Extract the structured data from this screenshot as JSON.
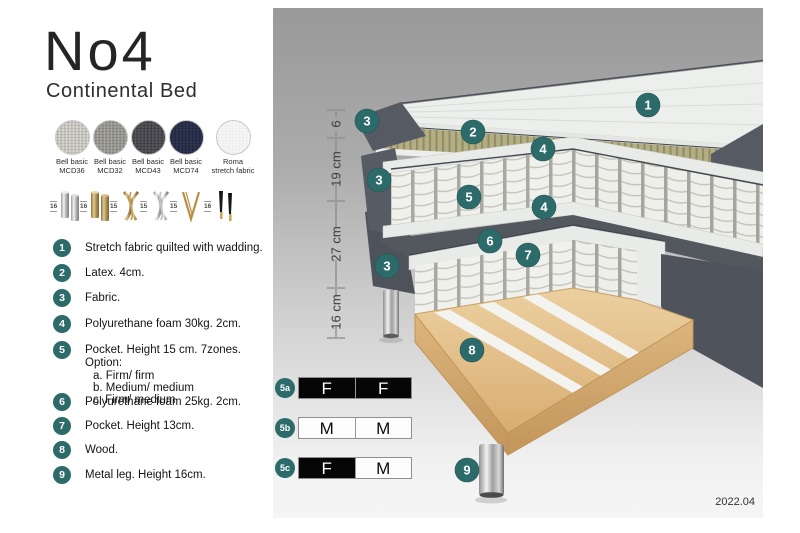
{
  "header": {
    "title": "No4",
    "subtitle": "Continental Bed"
  },
  "fabric_swatches": [
    {
      "line1": "Bell basic",
      "line2": "MCD36",
      "color": "#d6d4ce",
      "dot": "#aeaca4"
    },
    {
      "line1": "Bell basic",
      "line2": "MCD32",
      "color": "#a5a49e",
      "dot": "#807f79"
    },
    {
      "line1": "Bell basic",
      "line2": "MCD43",
      "color": "#55555a",
      "dot": "#393940"
    },
    {
      "line1": "Bell basic",
      "line2": "MCD74",
      "color": "#2f3554",
      "dot": "#1f2439"
    },
    {
      "line1": "Roma",
      "line2": "stretch fabric",
      "color": "#f7f7f7",
      "dot": "#ebebeb"
    }
  ],
  "leg_options": [
    {
      "height": "16",
      "style": "cylinder-silver"
    },
    {
      "height": "16",
      "style": "cylinder-brass"
    },
    {
      "height": "15",
      "style": "twist-gold"
    },
    {
      "height": "15",
      "style": "twist-silver"
    },
    {
      "height": "15",
      "style": "hairpin-gold"
    },
    {
      "height": "16",
      "style": "cone-black-gold"
    }
  ],
  "parts": [
    {
      "num": "1",
      "text": "Stretch fabric quilted with wadding.",
      "sub": []
    },
    {
      "num": "2",
      "text": "Latex. 4cm.",
      "sub": []
    },
    {
      "num": "3",
      "text": "Fabric.",
      "sub": []
    },
    {
      "num": "4",
      "text": "Polyurethane foam 30kg. 2cm.",
      "sub": []
    },
    {
      "num": "5",
      "text": "Pocket. Height 15 cm. 7zones. Option:",
      "sub": [
        "a. Firm/ firm",
        "b. Medium/ medium",
        "c. Firm/ medium"
      ]
    },
    {
      "num": "6",
      "text": "Polyurethane foam 25kg. 2cm.",
      "sub": []
    },
    {
      "num": "7",
      "text": "Pocket. Height 13cm.",
      "sub": []
    },
    {
      "num": "8",
      "text": "Wood.",
      "sub": []
    },
    {
      "num": "9",
      "text": "Metal leg. Height 16cm.",
      "sub": []
    }
  ],
  "diagram": {
    "measurements": [
      {
        "label": "6"
      },
      {
        "label": "19 cm"
      },
      {
        "label": "27 cm"
      },
      {
        "label": "16 cm"
      }
    ],
    "callouts": [
      {
        "label": "1"
      },
      {
        "label": "2"
      },
      {
        "label": "3"
      },
      {
        "label": "4"
      },
      {
        "label": "3"
      },
      {
        "label": "5"
      },
      {
        "label": "4"
      },
      {
        "label": "6"
      },
      {
        "label": "7"
      },
      {
        "label": "3"
      },
      {
        "label": "8"
      },
      {
        "label": "9"
      }
    ],
    "firmness_options": [
      {
        "id": "5a",
        "cells": [
          {
            "label": "F",
            "variant": "dark"
          },
          {
            "label": "F",
            "variant": "dark"
          }
        ]
      },
      {
        "id": "5b",
        "cells": [
          {
            "label": "M",
            "variant": "light"
          },
          {
            "label": "M",
            "variant": "light"
          }
        ]
      },
      {
        "id": "5c",
        "cells": [
          {
            "label": "F",
            "variant": "dark"
          },
          {
            "label": "M",
            "variant": "light"
          }
        ]
      }
    ],
    "version": "2022.04"
  },
  "colors": {
    "accent_teal": "#2d6b6a",
    "fabric_dark": "#565b63",
    "latex_khaki": "#b4ae85",
    "wood": "#ddb57e",
    "panel_top": "#999999",
    "panel_bottom": "#f5f5f5"
  }
}
